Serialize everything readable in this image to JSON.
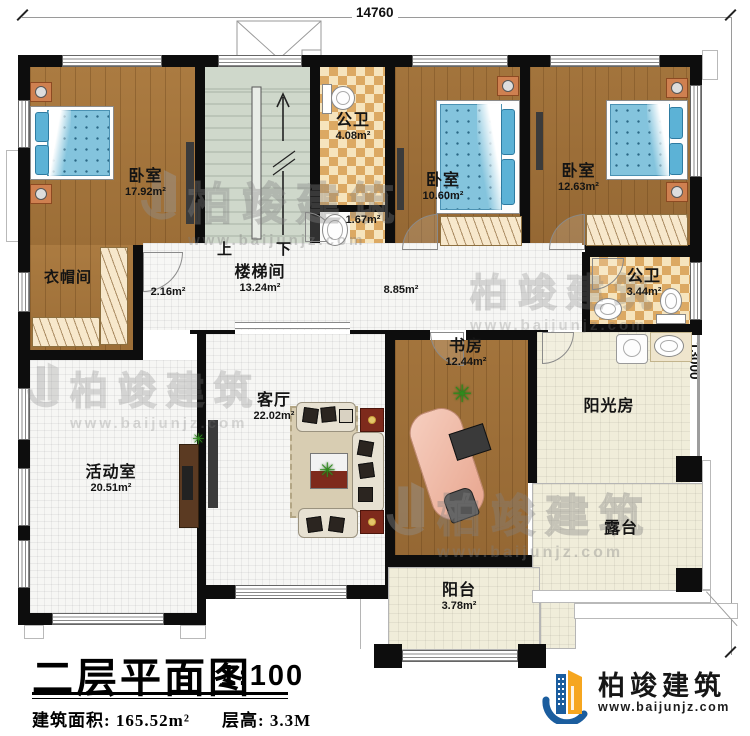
{
  "dimensions": {
    "width_mm": "14760",
    "height_mm": "13000"
  },
  "stairwell": {
    "up": "上",
    "down": "下"
  },
  "rooms": {
    "bedroom_left": {
      "name": "卧室",
      "area": "17.92m²"
    },
    "bath_top": {
      "name": "公卫",
      "area": "4.08m²"
    },
    "bath_top_annex": {
      "area": "1.67m²"
    },
    "bedroom_mid": {
      "name": "卧室",
      "area": "10.60m²"
    },
    "bedroom_right": {
      "name": "卧室",
      "area": "12.63m²"
    },
    "cloakroom": {
      "name": "衣帽间"
    },
    "cloak_hall": {
      "area": "2.16m²"
    },
    "stair_hall": {
      "name": "楼梯间",
      "area": "13.24m²"
    },
    "corridor": {
      "area": "8.85m²"
    },
    "bath_right": {
      "name": "公卫",
      "area": "3.44m²"
    },
    "study": {
      "name": "书房",
      "area": "12.44m²"
    },
    "living": {
      "name": "客厅",
      "area": "22.02m²"
    },
    "activity": {
      "name": "活动室",
      "area": "20.51m²"
    },
    "sunroom": {
      "name": "阳光房"
    },
    "terrace": {
      "name": "露台"
    },
    "balcony": {
      "name": "阳台",
      "area": "3.78m²"
    }
  },
  "title_block": {
    "title": "二层平面图",
    "scale": "1:100",
    "build_area": "建筑面积: 165.52m²",
    "floor_height": "层高: 3.3M"
  },
  "brand": {
    "name": "柏竣建筑",
    "url": "www.baijunjz.com"
  },
  "watermark": {
    "text": "柏竣建筑",
    "url": "www.baijunjz.com"
  },
  "colors": {
    "logo_blue": "#1b5d9e",
    "logo_orange": "#f6a61f",
    "wood": "#a9793f",
    "tile_dark": "#dca963",
    "tile_light": "#f6e4bd",
    "stair_floor": "#cfd8cb",
    "cream_tile": "#f0edda",
    "white_tile": "#f6f6f4"
  }
}
